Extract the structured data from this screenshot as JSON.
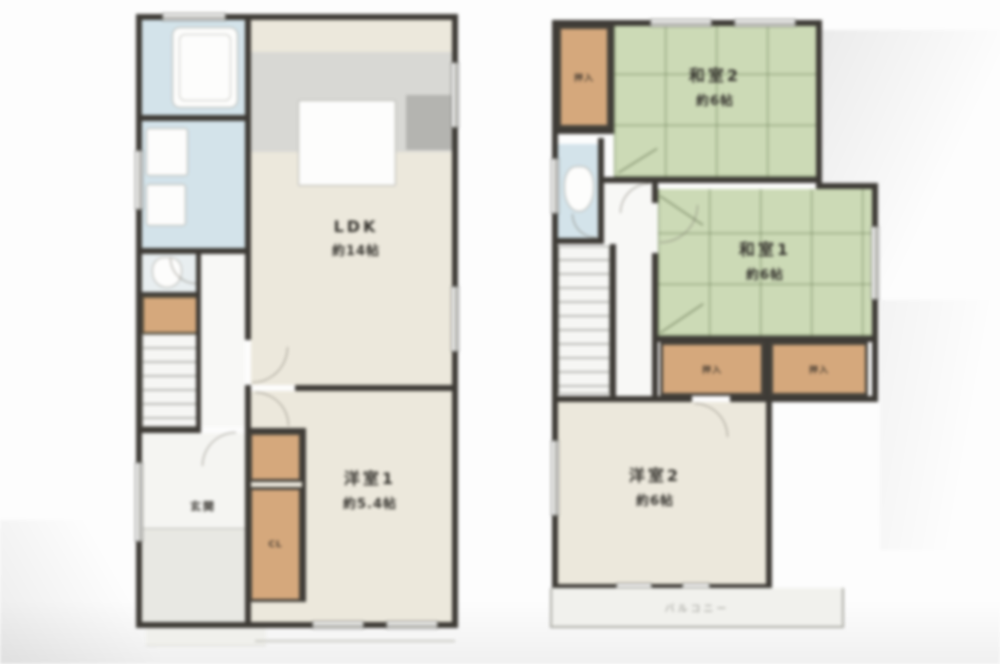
{
  "floor1": {
    "ldk": {
      "name": "LDK",
      "size": "約14帖"
    },
    "bedroom1": {
      "name": "洋室1",
      "size": "約5.4帖"
    },
    "closet_label": "CL",
    "entrance_label": "玄関"
  },
  "floor2": {
    "tatami2": {
      "name": "和室2",
      "size": "約6帖"
    },
    "tatami1": {
      "name": "和室1",
      "size": "約6帖"
    },
    "closet_top_label": "押入",
    "closet_a_label": "押入",
    "closet_b_label": "押入",
    "bedroom2": {
      "name": "洋室2",
      "size": "約6帖"
    },
    "balcony_label": "バルコニー"
  },
  "colors": {
    "wall": "#3e3b36",
    "tatami_green": "#ccdab6",
    "closet_wood": "#d5a87c",
    "water_blue": "#d3e3ea",
    "room_beige": "#ece8dc"
  }
}
